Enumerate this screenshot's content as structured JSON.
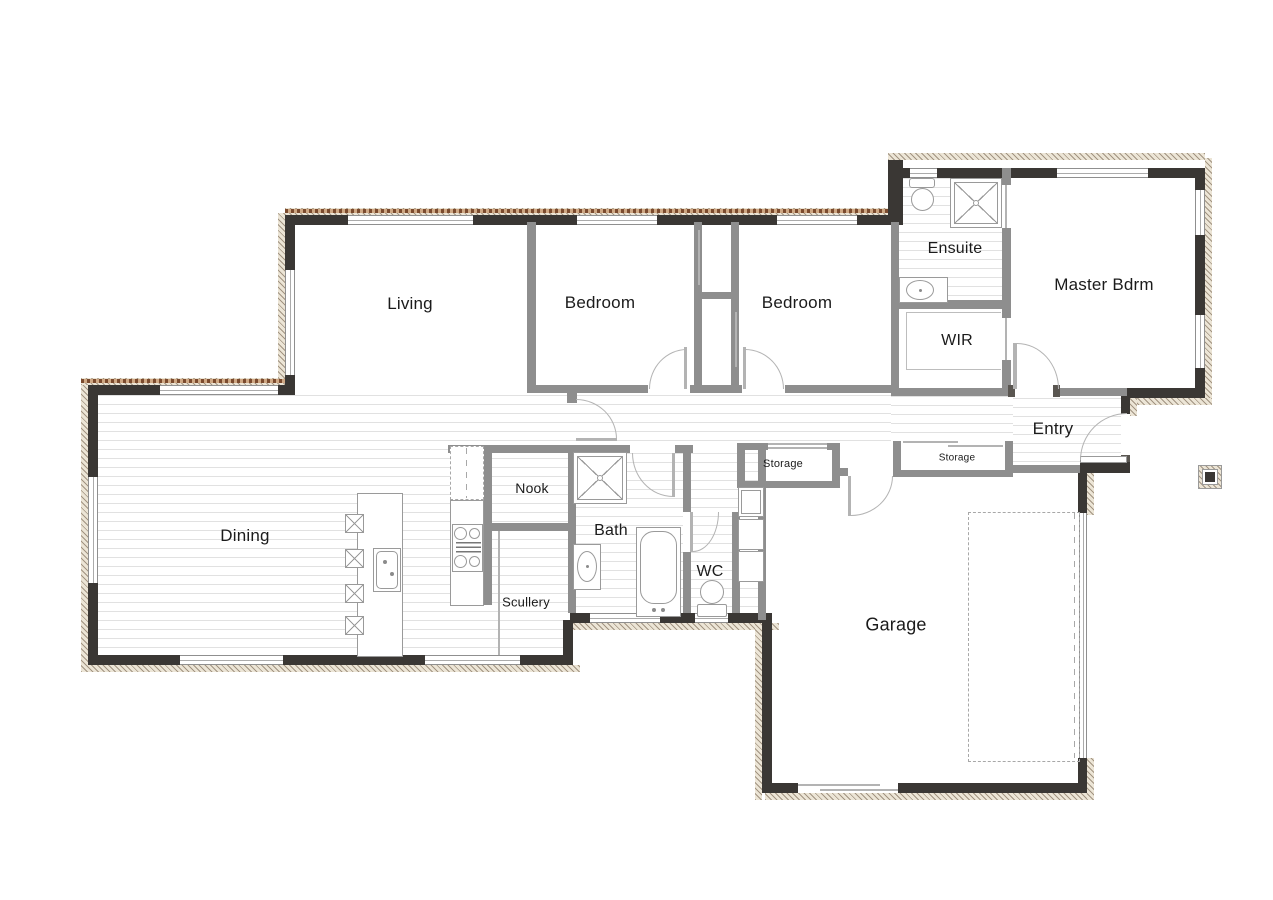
{
  "document": {
    "type": "architectural floor plan"
  },
  "colors": {
    "exterior_wall": "#3a3734",
    "interior_wall": "#8e8e8e",
    "cladding_hatch": "#ece5d6",
    "brick_edge": "#7b4b2e",
    "floor_line": "#e1e1e1",
    "fixture_line": "#9a9a9a",
    "text": "#1b1b1b",
    "background": "#ffffff"
  },
  "rooms": {
    "living": {
      "label": "Living"
    },
    "bedroom_left": {
      "label": "Bedroom"
    },
    "bedroom_right": {
      "label": "Bedroom"
    },
    "ensuite": {
      "label": "Ensuite"
    },
    "master": {
      "label": "Master Bdrm"
    },
    "wir": {
      "label": "WIR"
    },
    "entry": {
      "label": "Entry"
    },
    "storage_hall": {
      "label": "Storage"
    },
    "storage_entry": {
      "label": "Storage"
    },
    "nook": {
      "label": "Nook"
    },
    "bath": {
      "label": "Bath"
    },
    "wc": {
      "label": "WC"
    },
    "dining": {
      "label": "Dining"
    },
    "scullery": {
      "label": "Scullery"
    },
    "garage": {
      "label": "Garage"
    }
  },
  "symbols": {
    "exterior-wall": "dark-fill-with-hatched-cladding-strip",
    "interior-wall": "gray-fill",
    "window": "triple-parallel-lines",
    "door": "quarter-circle-swing-arc",
    "sliding-door": "thin-offset-line",
    "timber-floor": "horizontal-board-lines",
    "shower": "square-with-x-and-rose",
    "toilet": "ellipse-with-cistern",
    "vanity-basin": "oval-in-counter",
    "bathtub": "rounded-rect-with-taps",
    "laundry-tub": "square-in-square",
    "washing-machine": "stacked-squares",
    "fridge": "dashed-rect",
    "cooktop": "four-burner-circles-with-grill",
    "island-sink": "rounded-rect-with-taps",
    "bar-stool": "square-with-x",
    "wardrobe-shelf": "thin-outline",
    "car-space": "dashed-rect",
    "porch-column": "hatched-square-with-dark-core",
    "garage-door": "offset-thin-lines"
  }
}
